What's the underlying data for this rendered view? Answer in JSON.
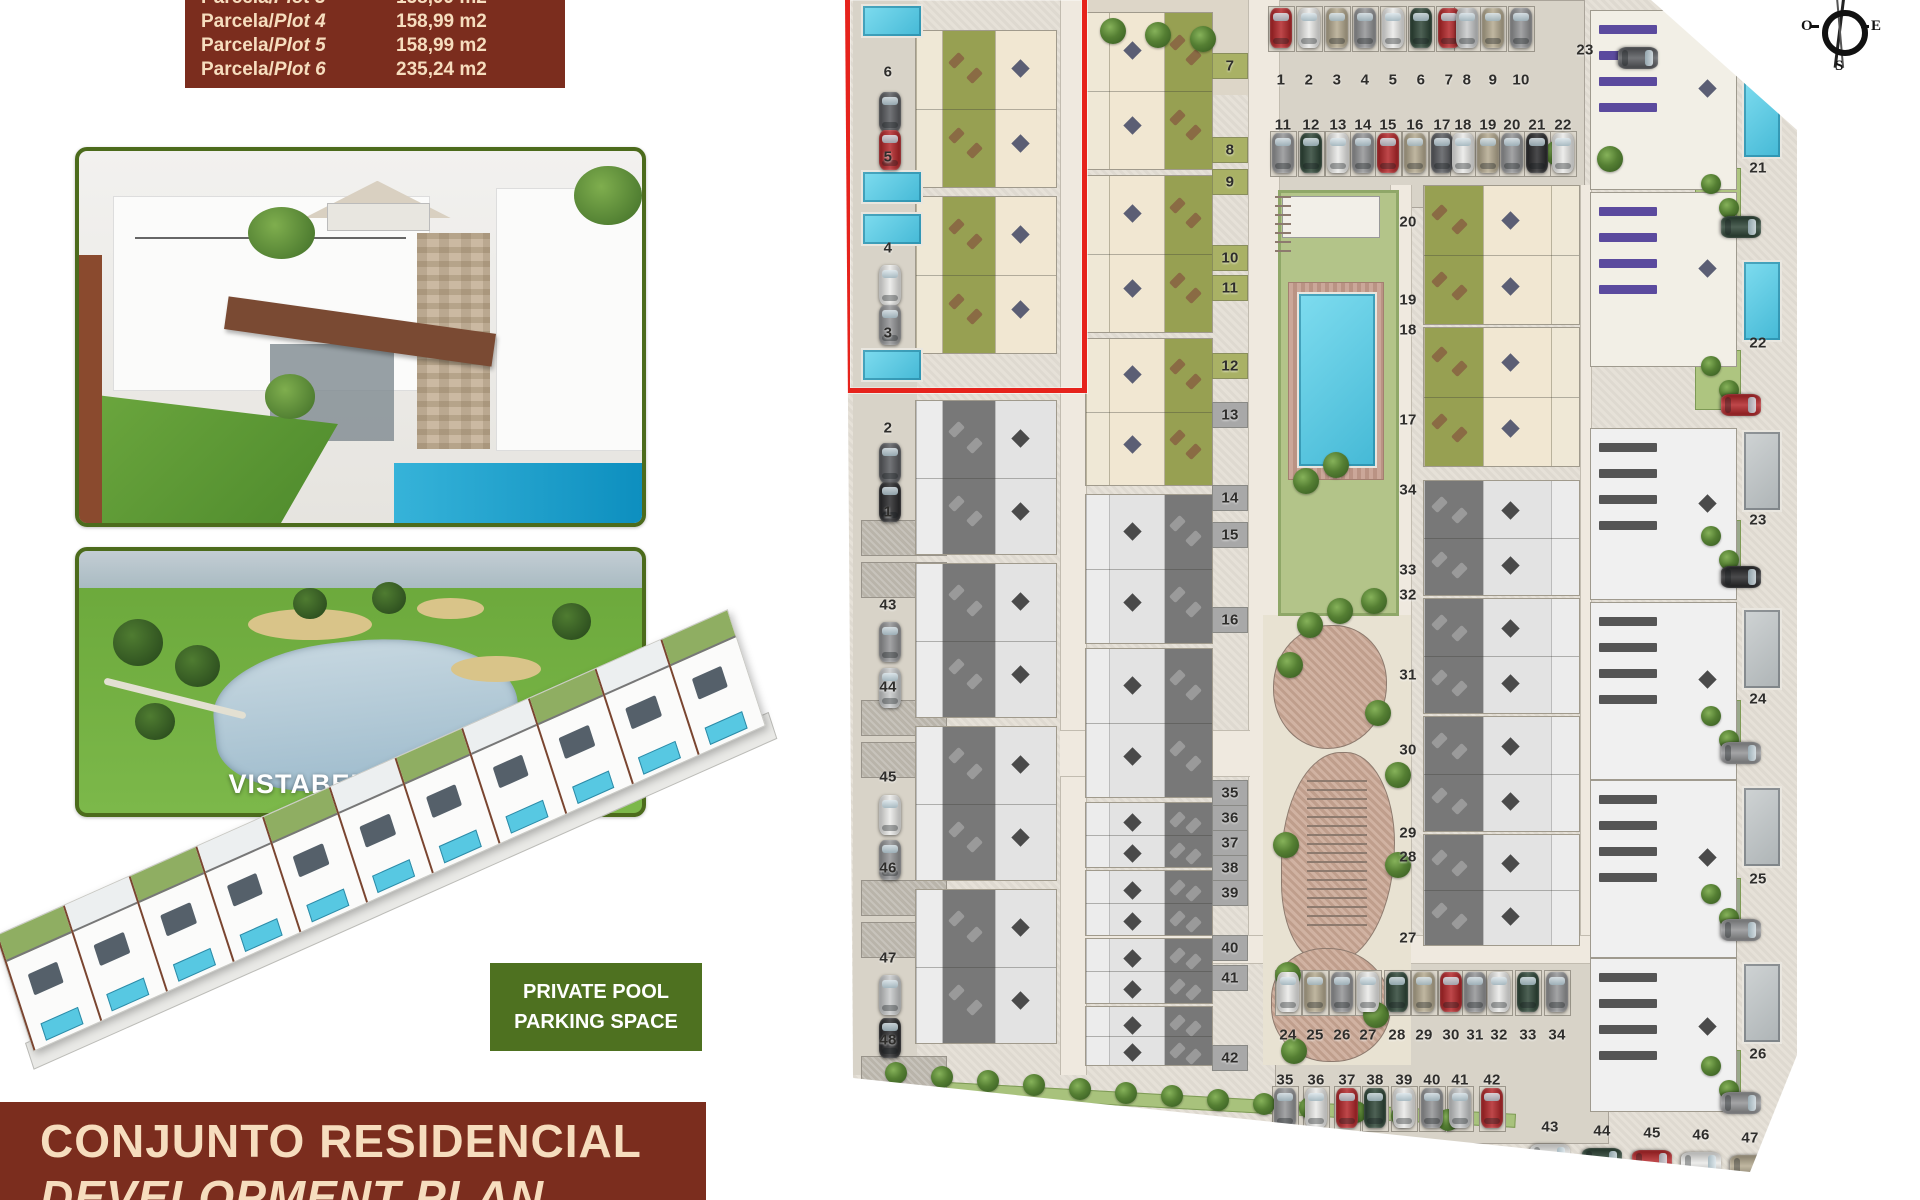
{
  "table": {
    "rows": [
      {
        "prefix": "Parcela/",
        "plot": "Plot 3",
        "area": "158,99  m2"
      },
      {
        "prefix": "Parcela/",
        "plot": "Plot 4",
        "area": "158,99  m2"
      },
      {
        "prefix": "Parcela/",
        "plot": "Plot 5",
        "area": "158,99  m2"
      },
      {
        "prefix": "Parcela/",
        "plot": "Plot 6",
        "area": "235,24  m2"
      }
    ]
  },
  "golf": {
    "label": "VISTABELLA GOLF"
  },
  "badge": {
    "line1": "PRIVATE POOL",
    "line2": "PARKING SPACE"
  },
  "banner": {
    "line1": "CONJUNTO RESIDENCIAL",
    "line2": "DEVELOPMENT PLAN"
  },
  "compass": {
    "west": "O",
    "east": "E",
    "south": "S"
  },
  "colors": {
    "maroon": "#7b2d1e",
    "cream": "#f6ddbe",
    "photo_border": "#4c6b1c",
    "badge_green": "#4e7120",
    "red_box": "#e6231c",
    "pool_cyan": "#57c8e2",
    "plan_bg": "#e4dfd6",
    "garden_green": "#97a052",
    "terrace_cream": "#f1e7d2",
    "gray_garden": "#787878",
    "solar_purple": "#5b4a9e",
    "cars": {
      "red": "#b01f22",
      "white": "#e9e9e7",
      "silver": "#c6c8c9",
      "gray": "#8f9092",
      "dark": "#54565a",
      "green": "#273f30",
      "black": "#232325",
      "beige": "#b2a78c"
    }
  },
  "plan": {
    "left_labels": [
      [
        "6",
        72
      ],
      [
        "5",
        157
      ],
      [
        "4",
        248
      ],
      [
        "3",
        333
      ],
      [
        "2",
        428
      ],
      [
        "1",
        512
      ],
      [
        "43",
        605
      ],
      [
        "44",
        687
      ],
      [
        "45",
        777
      ],
      [
        "46",
        868
      ],
      [
        "47",
        958
      ],
      [
        "48",
        1040
      ]
    ],
    "left_pools": [
      4,
      170,
      212,
      348
    ],
    "left_patches": [
      520,
      562,
      700,
      742,
      880,
      922,
      1056
    ],
    "left_cars": [
      [
        "dark",
        92
      ],
      [
        "red",
        130
      ],
      [
        "white",
        265
      ],
      [
        "gray",
        305
      ],
      [
        "dark",
        443
      ],
      [
        "black",
        482
      ],
      [
        "gray",
        622
      ],
      [
        "silver",
        668
      ],
      [
        "white",
        795
      ],
      [
        "gray",
        840
      ],
      [
        "silver",
        975
      ],
      [
        "black",
        1018
      ]
    ],
    "center_labels": [
      [
        "7",
        66,
        "g"
      ],
      [
        "8",
        150,
        "g"
      ],
      [
        "9",
        182,
        "g"
      ],
      [
        "10",
        258,
        "g"
      ],
      [
        "11",
        288,
        "g"
      ],
      [
        "12",
        366,
        "g"
      ],
      [
        "13",
        415,
        "x"
      ],
      [
        "14",
        498,
        "x"
      ],
      [
        "15",
        535,
        "x"
      ],
      [
        "16",
        620,
        "x"
      ],
      [
        "35",
        793,
        "x"
      ],
      [
        "36",
        818,
        "x"
      ],
      [
        "37",
        843,
        "x"
      ],
      [
        "38",
        868,
        "x"
      ],
      [
        "39",
        893,
        "x"
      ],
      [
        "40",
        948,
        "x"
      ],
      [
        "41",
        978,
        "x"
      ],
      [
        "42",
        1058,
        "x"
      ]
    ],
    "right_labels": [
      [
        "20",
        222
      ],
      [
        "19",
        300
      ],
      [
        "18",
        330
      ],
      [
        "17",
        420
      ],
      [
        "34",
        490
      ],
      [
        "33",
        570
      ],
      [
        "32",
        595
      ],
      [
        "31",
        675
      ],
      [
        "30",
        750
      ],
      [
        "29",
        833
      ],
      [
        "28",
        857
      ],
      [
        "27",
        938
      ]
    ],
    "far_labels": [
      [
        "21",
        168
      ],
      [
        "22",
        343
      ],
      [
        "23",
        520
      ],
      [
        "24",
        699
      ],
      [
        "25",
        879
      ],
      [
        "26",
        1054
      ]
    ],
    "parking_top": {
      "row1": {
        "num_y": 80,
        "car_y": 8,
        "items": [
          [
            "1",
            436,
            "red"
          ],
          [
            "2",
            464,
            "white"
          ],
          [
            "3",
            492,
            "beige"
          ],
          [
            "4",
            520,
            "gray"
          ],
          [
            "5",
            548,
            "white"
          ],
          [
            "6",
            576,
            "green"
          ],
          [
            "7",
            604,
            "red"
          ],
          [
            "8",
            622,
            "silver"
          ],
          [
            "9",
            648,
            "beige"
          ],
          [
            "10",
            676,
            "gray"
          ]
        ]
      },
      "row2": {
        "num_y": 125,
        "car_y": 133,
        "items": [
          [
            "11",
            438,
            "gray"
          ],
          [
            "12",
            466,
            "green"
          ],
          [
            "13",
            493,
            "white"
          ],
          [
            "14",
            518,
            "gray"
          ],
          [
            "15",
            543,
            "red"
          ],
          [
            "16",
            570,
            "beige"
          ],
          [
            "17",
            597,
            "dark"
          ],
          [
            "18",
            618,
            "white"
          ],
          [
            "19",
            643,
            "beige"
          ],
          [
            "20",
            667,
            "gray"
          ],
          [
            "21",
            692,
            "black"
          ],
          [
            "22",
            718,
            "white"
          ]
        ]
      },
      "extra": {
        "n": "23",
        "x": 740,
        "y": 50,
        "car": "dark",
        "car_x": 782,
        "car_y": 48
      }
    },
    "parking_bottom": {
      "row1": {
        "num_y": 1035,
        "car_y": 972,
        "items": [
          [
            "24",
            443,
            "white"
          ],
          [
            "25",
            470,
            "beige"
          ],
          [
            "26",
            497,
            "gray"
          ],
          [
            "27",
            523,
            "white"
          ],
          [
            "28",
            552,
            "green"
          ],
          [
            "29",
            579,
            "beige"
          ],
          [
            "30",
            606,
            "red"
          ],
          [
            "31",
            630,
            "gray"
          ],
          [
            "32",
            654,
            "white"
          ],
          [
            "33",
            683,
            "green"
          ],
          [
            "34",
            712,
            "gray"
          ]
        ]
      },
      "row2": {
        "num_y": 1080,
        "car_y": 1088,
        "items": [
          [
            "35",
            440,
            "gray"
          ],
          [
            "36",
            471,
            "white"
          ],
          [
            "37",
            502,
            "red"
          ],
          [
            "38",
            530,
            "green"
          ],
          [
            "39",
            559,
            "white"
          ],
          [
            "40",
            587,
            "gray"
          ],
          [
            "41",
            615,
            "silver"
          ],
          [
            "42",
            647,
            "red"
          ]
        ]
      },
      "row3": {
        "items": [
          [
            "43",
            705,
            1127,
            "white"
          ],
          [
            "44",
            757,
            1131,
            "green"
          ],
          [
            "45",
            807,
            1133,
            "red"
          ],
          [
            "46",
            856,
            1135,
            "white"
          ],
          [
            "47",
            905,
            1138,
            "beige"
          ]
        ]
      }
    },
    "blocks": [
      [
        "c",
        70,
        30,
        142,
        158,
        "bgt"
      ],
      [
        "c",
        70,
        196,
        142,
        158,
        "bgt"
      ],
      [
        "g",
        70,
        400,
        142,
        155,
        "bgt"
      ],
      [
        "g",
        70,
        563,
        142,
        155,
        "bgt"
      ],
      [
        "g",
        70,
        726,
        142,
        155,
        "bgt"
      ],
      [
        "g",
        70,
        889,
        142,
        155,
        "bgt"
      ],
      [
        "c",
        240,
        12,
        128,
        158,
        "btg"
      ],
      [
        "c",
        240,
        175,
        128,
        158,
        "btg"
      ],
      [
        "c",
        240,
        338,
        128,
        148,
        "btg"
      ],
      [
        "g",
        240,
        494,
        128,
        150,
        "btg"
      ],
      [
        "g",
        240,
        648,
        128,
        150,
        "btg"
      ],
      [
        "g",
        240,
        802,
        128,
        66,
        "btg"
      ],
      [
        "g",
        240,
        870,
        128,
        66,
        "btg"
      ],
      [
        "g",
        240,
        938,
        128,
        66,
        "btg"
      ],
      [
        "g",
        240,
        1006,
        128,
        60,
        "btg"
      ],
      [
        "c",
        578,
        185,
        157,
        140,
        "gtb"
      ],
      [
        "c",
        578,
        327,
        157,
        140,
        "gtb"
      ],
      [
        "g",
        578,
        480,
        157,
        116,
        "gtb"
      ],
      [
        "g",
        578,
        598,
        157,
        116,
        "gtb"
      ],
      [
        "g",
        578,
        716,
        157,
        116,
        "gtb"
      ],
      [
        "g",
        578,
        834,
        157,
        112,
        "gtb"
      ]
    ],
    "villas": [
      {
        "y": 10,
        "h": 178,
        "phase": "c",
        "pool_y": 77,
        "car_y": 207,
        "car": "green",
        "gy": 168
      },
      {
        "y": 192,
        "h": 173,
        "phase": "c",
        "pool_y": 260,
        "car_y": 385,
        "car": "red",
        "gy": 350
      },
      {
        "y": 428,
        "h": 170,
        "phase": "g",
        "pool_y": 430,
        "car_y": 557,
        "car": "black",
        "gy": 520
      },
      {
        "y": 602,
        "h": 176,
        "phase": "g",
        "pool_y": 608,
        "car_y": 733,
        "car": "gray",
        "gy": 700
      },
      {
        "y": 780,
        "h": 176,
        "phase": "g",
        "pool_y": 786,
        "car_y": 910,
        "car": "gray",
        "gy": 878
      },
      {
        "y": 958,
        "h": 152,
        "phase": "g",
        "pool_y": 962,
        "car_y": 1083,
        "car": "gray",
        "gy": 1050
      }
    ]
  }
}
